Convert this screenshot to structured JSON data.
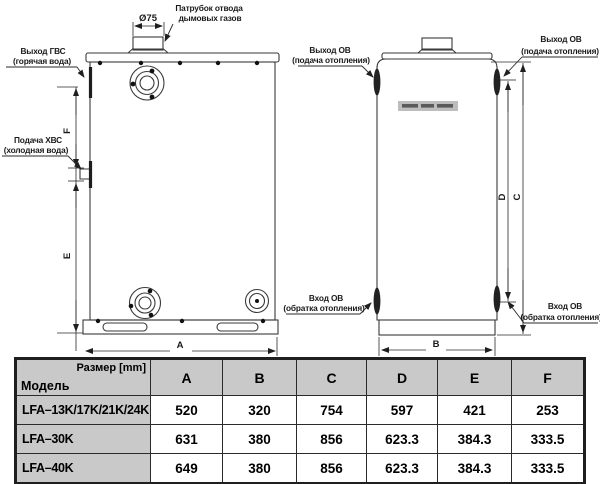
{
  "diagram": {
    "flue_dim": "Ø75",
    "labels": {
      "flue_1": "Патрубок отвода",
      "flue_2": "дымовых газов",
      "dhw_out_1": "Выход ГВС",
      "dhw_out_2": "(горячая вода)",
      "cold_in_1": "Подача ХВС",
      "cold_in_2": "(холодная вода)",
      "ch_out_mid_1": "Выход ОВ",
      "ch_out_mid_2": "(подача отопления)",
      "ch_out_right_1": "Выход ОВ",
      "ch_out_right_2": "(подача отопления)",
      "ch_in_mid_1": "Вход ОВ",
      "ch_in_mid_2": "(обратка отопления)",
      "ch_in_right_1": "Вход ОВ",
      "ch_in_right_2": "(обратка отопления)"
    },
    "dims": {
      "A": "A",
      "B": "B",
      "C": "C",
      "D": "D",
      "E": "E",
      "F": "F"
    }
  },
  "table": {
    "size_label": "Размер [mm]",
    "model_label": "Модель",
    "columns": [
      "A",
      "B",
      "C",
      "D",
      "E",
      "F"
    ],
    "rows": [
      {
        "model": "LFA–13K/17K/21K/24K",
        "values": [
          "520",
          "320",
          "754",
          "597",
          "421",
          "253"
        ]
      },
      {
        "model": "LFA–30K",
        "values": [
          "631",
          "380",
          "856",
          "623.3",
          "384.3",
          "333.5"
        ]
      },
      {
        "model": "LFA–40K",
        "values": [
          "649",
          "380",
          "856",
          "623.3",
          "384.3",
          "333.5"
        ]
      }
    ]
  }
}
